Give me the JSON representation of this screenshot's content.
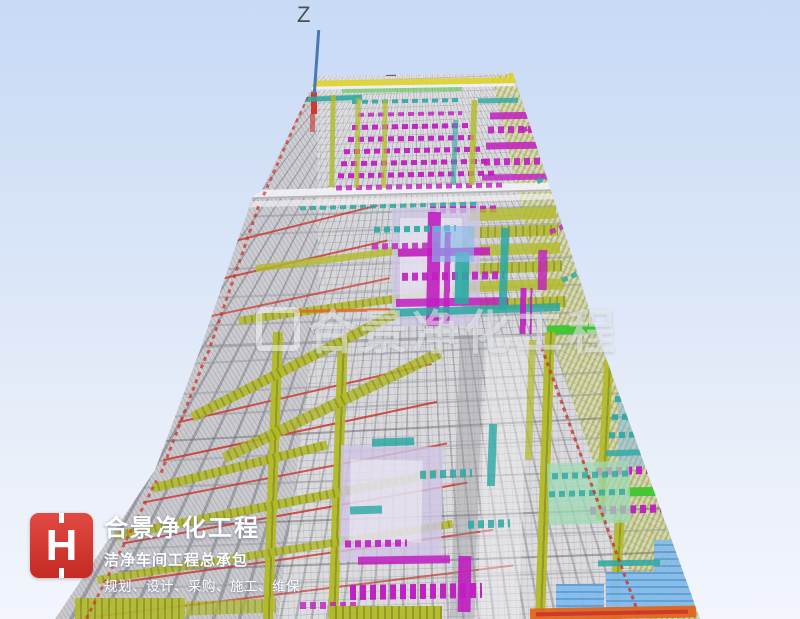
{
  "meta": {
    "width": 800,
    "height": 619,
    "description": "3D BIM/MEP perspective render of long cleanroom workshop building"
  },
  "axis": {
    "label": "Z",
    "color": "#4878b8"
  },
  "watermark": {
    "text": "合景净化工程"
  },
  "logo": {
    "monogram": "H",
    "title": "合景净化工程",
    "subtitle": "洁净车间工程总承包",
    "tagline": "规划、设计、采购、施工、维保",
    "brand_color": "#d3312c"
  },
  "scene": {
    "sky_top": "#c8daf5",
    "sky_bottom": "#f2f5fc",
    "outline": [
      [
        317,
        76
      ],
      [
        513,
        73
      ],
      [
        596,
        330
      ],
      [
        700,
        619
      ],
      [
        55,
        619
      ],
      [
        155,
        470
      ],
      [
        200,
        350
      ],
      [
        253,
        196
      ],
      [
        262,
        190
      ]
    ],
    "left_wall": [
      [
        317,
        76
      ],
      [
        262,
        190
      ],
      [
        253,
        196
      ],
      [
        200,
        350
      ],
      [
        155,
        470
      ],
      [
        55,
        619
      ],
      [
        278,
        619
      ],
      [
        318,
        300
      ]
    ],
    "right_wall": [
      [
        513,
        73
      ],
      [
        596,
        330
      ],
      [
        700,
        619
      ],
      [
        646,
        619
      ],
      [
        549,
        330
      ],
      [
        492,
        78
      ]
    ],
    "palette": {
      "ol": "#b2ba28",
      "olD": "repeating-linear-gradient(90deg,#b2ba28 0 5px,#8f9620 5px 7px)",
      "mg": "#c01ec0",
      "mgD": "repeating-linear-gradient(90deg,#c01ec0 0 6px,rgba(192,30,192,0) 6px 10px)",
      "tl": "#2ba8a2",
      "tlD": "repeating-linear-gradient(90deg,#2ba8a2 0 6px,rgba(43,168,162,0) 6px 10px)",
      "rd": "#cb342c",
      "rdD": "repeating-linear-gradient(0deg,#cb342c 0 4px,rgba(0,0,0,0) 4px 8px)",
      "gn": "#3dc72e",
      "lv": "#cfc5e6",
      "bl": "#84bcec",
      "blD": "repeating-linear-gradient(0deg,#84bcec 0 5px,#5d9ed8 5px 7px)",
      "mint": "#9fd9b4",
      "wh": "#f3f3f6",
      "gy": "#8f9096",
      "dk": "#55565c",
      "og": "#e2661c",
      "yw": "#e0d322"
    },
    "shape_format": "[x, y, width, height, rotate_deg, palette_key, opacity]",
    "shapes": [
      [
        255,
        210,
        310,
        2,
        -2,
        "gy",
        0.5
      ],
      [
        240,
        228,
        330,
        2,
        -2,
        "gy",
        0.4
      ],
      [
        228,
        262,
        350,
        2,
        -2,
        "gy",
        0.45
      ],
      [
        215,
        290,
        370,
        2,
        -2,
        "gy",
        0.4
      ],
      [
        200,
        318,
        390,
        2,
        -2,
        "gy",
        0.45
      ],
      [
        190,
        352,
        410,
        2,
        -3,
        "gy",
        0.45
      ],
      [
        178,
        382,
        430,
        2,
        -3,
        "gy",
        0.4
      ],
      [
        168,
        404,
        450,
        2,
        -3,
        "gy",
        0.45
      ],
      [
        150,
        448,
        480,
        2,
        -3,
        "gy",
        0.4
      ],
      [
        142,
        478,
        500,
        2,
        -2,
        "gy",
        0.45
      ],
      [
        128,
        538,
        540,
        2,
        -2,
        "gy",
        0.4
      ],
      [
        112,
        578,
        580,
        2,
        -2,
        "gy",
        0.4
      ],
      [
        160,
        428,
        470,
        2,
        -3,
        "dk",
        0.4
      ],
      [
        135,
        516,
        560,
        2,
        -2,
        "dk",
        0.45
      ],
      [
        118,
        560,
        600,
        2,
        -2,
        "dk",
        0.4
      ],
      [
        205,
        338,
        392,
        3,
        -2,
        "gy",
        0.6
      ],
      [
        210,
        225,
        170,
        2,
        -14,
        "rd",
        0.8
      ],
      [
        190,
        262,
        200,
        2,
        -13,
        "rd",
        0.8
      ],
      [
        172,
        300,
        220,
        2,
        -12,
        "rd",
        0.7
      ],
      [
        175,
        392,
        260,
        2,
        -13,
        "rd",
        0.8
      ],
      [
        160,
        430,
        280,
        2,
        -12,
        "rd",
        0.85
      ],
      [
        140,
        472,
        310,
        2,
        -11,
        "rd",
        0.8
      ],
      [
        120,
        512,
        350,
        2,
        -10,
        "rd",
        0.85
      ],
      [
        105,
        556,
        390,
        2,
        -8,
        "rd",
        0.8
      ],
      [
        95,
        590,
        420,
        2,
        -7,
        "rd",
        0.7
      ],
      [
        250,
        186,
        322,
        9,
        -1.5,
        "wh",
        0.9
      ],
      [
        246,
        197,
        330,
        6,
        -1.5,
        "wh",
        0.65
      ],
      [
        250,
        193,
        320,
        2,
        -1.5,
        "gy",
        0.6
      ],
      [
        300,
        204,
        180,
        4,
        -1.5,
        "tlD",
        0.85
      ],
      [
        430,
        206,
        70,
        7,
        -1,
        "mgD",
        0.9
      ],
      [
        300,
        79,
        215,
        6,
        -1,
        "yw",
        0.85
      ],
      [
        302,
        85,
        213,
        3,
        -1,
        "wh",
        0.9
      ],
      [
        386,
        62,
        10,
        14,
        0,
        "dk",
        0.9
      ],
      [
        383,
        70,
        16,
        4,
        0,
        "gy",
        0.9
      ],
      [
        509,
        62,
        7,
        15,
        0,
        "yw",
        1
      ],
      [
        311,
        92,
        6,
        22,
        0,
        "rd",
        0.95
      ],
      [
        310,
        114,
        5,
        18,
        0,
        "rd",
        0.6
      ],
      [
        300,
        96,
        62,
        5,
        -2,
        "tl",
        0.9
      ],
      [
        352,
        99,
        110,
        4,
        -1,
        "tlD",
        0.9
      ],
      [
        342,
        88,
        120,
        4,
        -1,
        "gn",
        0.5
      ],
      [
        358,
        112,
        104,
        4,
        -1,
        "mgD",
        0.8
      ],
      [
        352,
        124,
        118,
        5,
        -1,
        "mgD",
        0.95
      ],
      [
        348,
        136,
        128,
        5,
        -1,
        "mgD",
        0.95
      ],
      [
        344,
        148,
        138,
        5,
        -1,
        "mgD",
        0.95
      ],
      [
        341,
        160,
        148,
        5,
        -1,
        "mgD",
        0.95
      ],
      [
        338,
        172,
        158,
        5,
        -1,
        "mgD",
        0.95
      ],
      [
        336,
        184,
        166,
        5,
        -1,
        "mgD",
        0.8
      ],
      [
        490,
        112,
        58,
        7,
        -1,
        "mg",
        0.85
      ],
      [
        488,
        126,
        62,
        7,
        -1,
        "mgD",
        0.9
      ],
      [
        486,
        142,
        66,
        7,
        -1,
        "mg",
        0.85
      ],
      [
        484,
        158,
        70,
        7,
        -1,
        "mgD",
        0.9
      ],
      [
        482,
        174,
        72,
        6,
        -1,
        "mg",
        0.8
      ],
      [
        478,
        98,
        40,
        5,
        -1,
        "tl",
        0.8
      ],
      [
        330,
        95,
        5,
        92,
        1,
        "ol",
        0.8
      ],
      [
        355,
        98,
        5,
        90,
        1,
        "ol",
        0.7
      ],
      [
        382,
        100,
        5,
        88,
        1,
        "ol",
        0.7
      ],
      [
        470,
        100,
        6,
        85,
        2,
        "ol",
        0.8
      ],
      [
        452,
        120,
        5,
        65,
        2,
        "tl",
        0.6
      ],
      [
        255,
        252,
        212,
        7,
        -7,
        "ol",
        0.8
      ],
      [
        238,
        300,
        240,
        8,
        -8,
        "olD",
        0.85
      ],
      [
        470,
        208,
        86,
        12,
        -2,
        "ol",
        0.8
      ],
      [
        468,
        226,
        90,
        11,
        -2,
        "olD",
        0.85
      ],
      [
        466,
        244,
        94,
        11,
        -2,
        "ol",
        0.8
      ],
      [
        464,
        262,
        98,
        11,
        -2,
        "olD",
        0.85
      ],
      [
        462,
        280,
        102,
        11,
        -2,
        "ol",
        0.8
      ],
      [
        460,
        298,
        106,
        11,
        -2,
        "olD",
        0.85
      ],
      [
        392,
        208,
        88,
        118,
        0,
        "lv",
        0.75
      ],
      [
        400,
        218,
        62,
        92,
        0,
        "wh",
        0.5
      ],
      [
        427,
        212,
        13,
        114,
        1,
        "mg",
        0.9
      ],
      [
        444,
        232,
        10,
        92,
        1,
        "mgD",
        0.85
      ],
      [
        398,
        248,
        92,
        8,
        -1,
        "mg",
        0.9
      ],
      [
        402,
        272,
        102,
        8,
        -1,
        "mgD",
        0.9
      ],
      [
        396,
        298,
        112,
        8,
        -1,
        "mg",
        0.85
      ],
      [
        374,
        226,
        82,
        6,
        -1,
        "tlD",
        0.9
      ],
      [
        372,
        243,
        66,
        6,
        -1,
        "mgD",
        0.8
      ],
      [
        455,
        252,
        14,
        52,
        1,
        "tl",
        0.9
      ],
      [
        500,
        228,
        8,
        82,
        2,
        "tl",
        0.85
      ],
      [
        388,
        306,
        172,
        8,
        -2,
        "tl",
        0.85
      ],
      [
        432,
        226,
        42,
        36,
        0,
        "bl",
        0.6
      ],
      [
        520,
        288,
        12,
        46,
        1,
        "mgD",
        0.9
      ],
      [
        538,
        250,
        9,
        40,
        1,
        "mg",
        0.8
      ],
      [
        547,
        325,
        52,
        9,
        -1,
        "gn",
        0.95
      ],
      [
        295,
        309,
        95,
        3,
        -1,
        "og",
        0.85
      ],
      [
        268,
        332,
        10,
        287,
        2,
        "olD",
        0.95
      ],
      [
        333,
        340,
        10,
        279,
        2,
        "olD",
        0.95
      ],
      [
        180,
        360,
        230,
        10,
        -27,
        "olD",
        0.9
      ],
      [
        212,
        400,
        240,
        11,
        -26,
        "olD",
        0.85
      ],
      [
        150,
        462,
        180,
        9,
        -14,
        "olD",
        0.9
      ],
      [
        112,
        500,
        330,
        9,
        -11,
        "olD",
        0.9
      ],
      [
        95,
        548,
        360,
        8,
        -9,
        "olD",
        0.85
      ],
      [
        540,
        332,
        10,
        288,
        2,
        "olD",
        0.95
      ],
      [
        600,
        360,
        9,
        160,
        3,
        "olD",
        0.9
      ],
      [
        612,
        520,
        10,
        99,
        3,
        "olD",
        0.9
      ],
      [
        527,
        340,
        7,
        120,
        2,
        "ol",
        0.7
      ],
      [
        455,
        335,
        24,
        284,
        2,
        "gy",
        0.35
      ],
      [
        482,
        335,
        42,
        284,
        2,
        "wh",
        0.4
      ],
      [
        618,
        385,
        72,
        82,
        0,
        "bl",
        0.5
      ],
      [
        615,
        395,
        72,
        6,
        -2,
        "tlD",
        0.9
      ],
      [
        612,
        413,
        76,
        6,
        -2,
        "tlD",
        0.9
      ],
      [
        609,
        431,
        80,
        6,
        -2,
        "tlD",
        0.9
      ],
      [
        606,
        449,
        84,
        6,
        -2,
        "tl",
        0.8
      ],
      [
        596,
        466,
        100,
        8,
        -2,
        "mgD",
        0.95
      ],
      [
        590,
        505,
        108,
        8,
        -2,
        "mgD",
        0.95
      ],
      [
        628,
        487,
        48,
        9,
        -1,
        "gn",
        0.95
      ],
      [
        548,
        462,
        82,
        62,
        -2,
        "mint",
        0.75
      ],
      [
        552,
        472,
        76,
        6,
        -2,
        "tlD",
        0.8
      ],
      [
        549,
        490,
        80,
        6,
        -2,
        "tlD",
        0.8
      ],
      [
        340,
        446,
        102,
        116,
        1,
        "lv",
        0.8
      ],
      [
        350,
        460,
        72,
        82,
        1,
        "wh",
        0.5
      ],
      [
        372,
        438,
        42,
        8,
        -2,
        "tl",
        0.85
      ],
      [
        420,
        470,
        52,
        8,
        -2,
        "tlD",
        0.85
      ],
      [
        350,
        506,
        32,
        8,
        -2,
        "tl",
        0.8
      ],
      [
        468,
        520,
        42,
        8,
        -2,
        "tlD",
        0.85
      ],
      [
        488,
        424,
        8,
        62,
        2,
        "tl",
        0.8
      ],
      [
        345,
        540,
        62,
        7,
        -1,
        "mgD",
        0.9
      ],
      [
        358,
        556,
        92,
        8,
        -1,
        "mg",
        0.85
      ],
      [
        350,
        584,
        132,
        15,
        -1,
        "mgD",
        0.98
      ],
      [
        458,
        556,
        13,
        56,
        1,
        "mg",
        0.9
      ],
      [
        300,
        602,
        60,
        7,
        0,
        "mgD",
        0.8
      ],
      [
        556,
        584,
        48,
        28,
        0,
        "blD",
        0.95
      ],
      [
        606,
        572,
        88,
        42,
        0,
        "blD",
        0.95
      ],
      [
        654,
        540,
        42,
        32,
        0,
        "blD",
        0.9
      ],
      [
        598,
        560,
        62,
        6,
        -1,
        "tl",
        0.85
      ],
      [
        530,
        607,
        166,
        12,
        -1,
        "og",
        0.95
      ],
      [
        536,
        611,
        152,
        4,
        -1,
        "rd",
        0.9
      ],
      [
        330,
        606,
        112,
        13,
        0,
        "olD",
        0.95
      ],
      [
        75,
        598,
        110,
        21,
        0,
        "olD",
        0.9
      ],
      [
        186,
        600,
        90,
        14,
        -2,
        "olD",
        0.7
      ],
      [
        232,
        200,
        3,
        158,
        19,
        "rdD",
        0.75
      ],
      [
        182,
        352,
        3,
        125,
        21,
        "rdD",
        0.75
      ],
      [
        120,
        472,
        3,
        155,
        27,
        "rdD",
        0.7
      ],
      [
        284,
        92,
        3,
        108,
        24,
        "rdD",
        0.7
      ],
      [
        588,
        335,
        3,
        288,
        -20,
        "rdD",
        0.8
      ],
      [
        520,
        120,
        40,
        5,
        -25,
        "mgD",
        0.8
      ],
      [
        535,
        170,
        44,
        5,
        -25,
        "tlD",
        0.8
      ],
      [
        548,
        220,
        48,
        5,
        -24,
        "mgD",
        0.8
      ],
      [
        560,
        268,
        50,
        5,
        -23,
        "tlD",
        0.8
      ],
      [
        700,
        598,
        26,
        21,
        0,
        "wh",
        0.6
      ]
    ]
  }
}
